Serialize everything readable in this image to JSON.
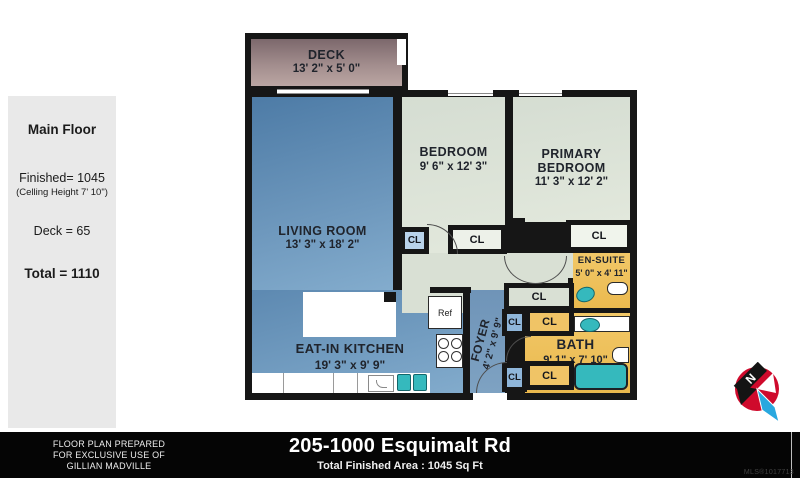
{
  "sidebar": {
    "title": "Main Floor",
    "finished": "Finished= 1045",
    "ceiling": "(Celling Height 7' 10\")",
    "deck": "Deck = 65",
    "total": "Total = 1110"
  },
  "rooms": {
    "deck": {
      "name": "DECK",
      "dims": "13' 2\" x 5' 0\""
    },
    "living": {
      "name": "LIVING ROOM",
      "dims": "13' 3\" x 18' 2\""
    },
    "bedroom": {
      "name": "BEDROOM",
      "dims": "9' 6\" x 12' 3\""
    },
    "primary": {
      "name": "PRIMARY BEDROOM",
      "dims": "11' 3\" x 12' 2\""
    },
    "ensuite": {
      "name": "EN-SUITE",
      "dims": "5' 0\" x 4' 11\""
    },
    "bath": {
      "name": "BATH",
      "dims": "9' 1\" x 7' 10\""
    },
    "kitchen": {
      "name": "EAT-IN KITCHEN",
      "dims": "19' 3\" x 9' 9\""
    },
    "foyer": {
      "name": "FOYER",
      "dims": "4' 2\" x 9' 9\""
    }
  },
  "labels": {
    "closet": "CL",
    "fridge": "Ref",
    "north": "N"
  },
  "footer": {
    "prepared_line1": "FLOOR PLAN PREPARED",
    "prepared_line2": "FOR EXCLUSIVE USE OF",
    "prepared_line3": "GILLIAN MADVILLE",
    "address": "205-1000 Esquimalt Rd",
    "area": "Total Finished Area : 1045 Sq Ft",
    "mls": "MLS®1017713"
  },
  "colors": {
    "wall": "#161616",
    "living_blue": "#5d89b1",
    "kitchen_blue": "#6f98bd",
    "foyer_blue": "#7397b8",
    "bedroom_sage": "#dce3d6",
    "bath_yellow": "#f0c25f",
    "deck_mauve": "#a08b8a",
    "closet_blue_light": "#b9d3ea",
    "closet_blue": "#8fb6da",
    "fixture_teal": "#35b9bd",
    "footer_bg": "#050505",
    "sidebar_gray": "#e9e9e9"
  }
}
